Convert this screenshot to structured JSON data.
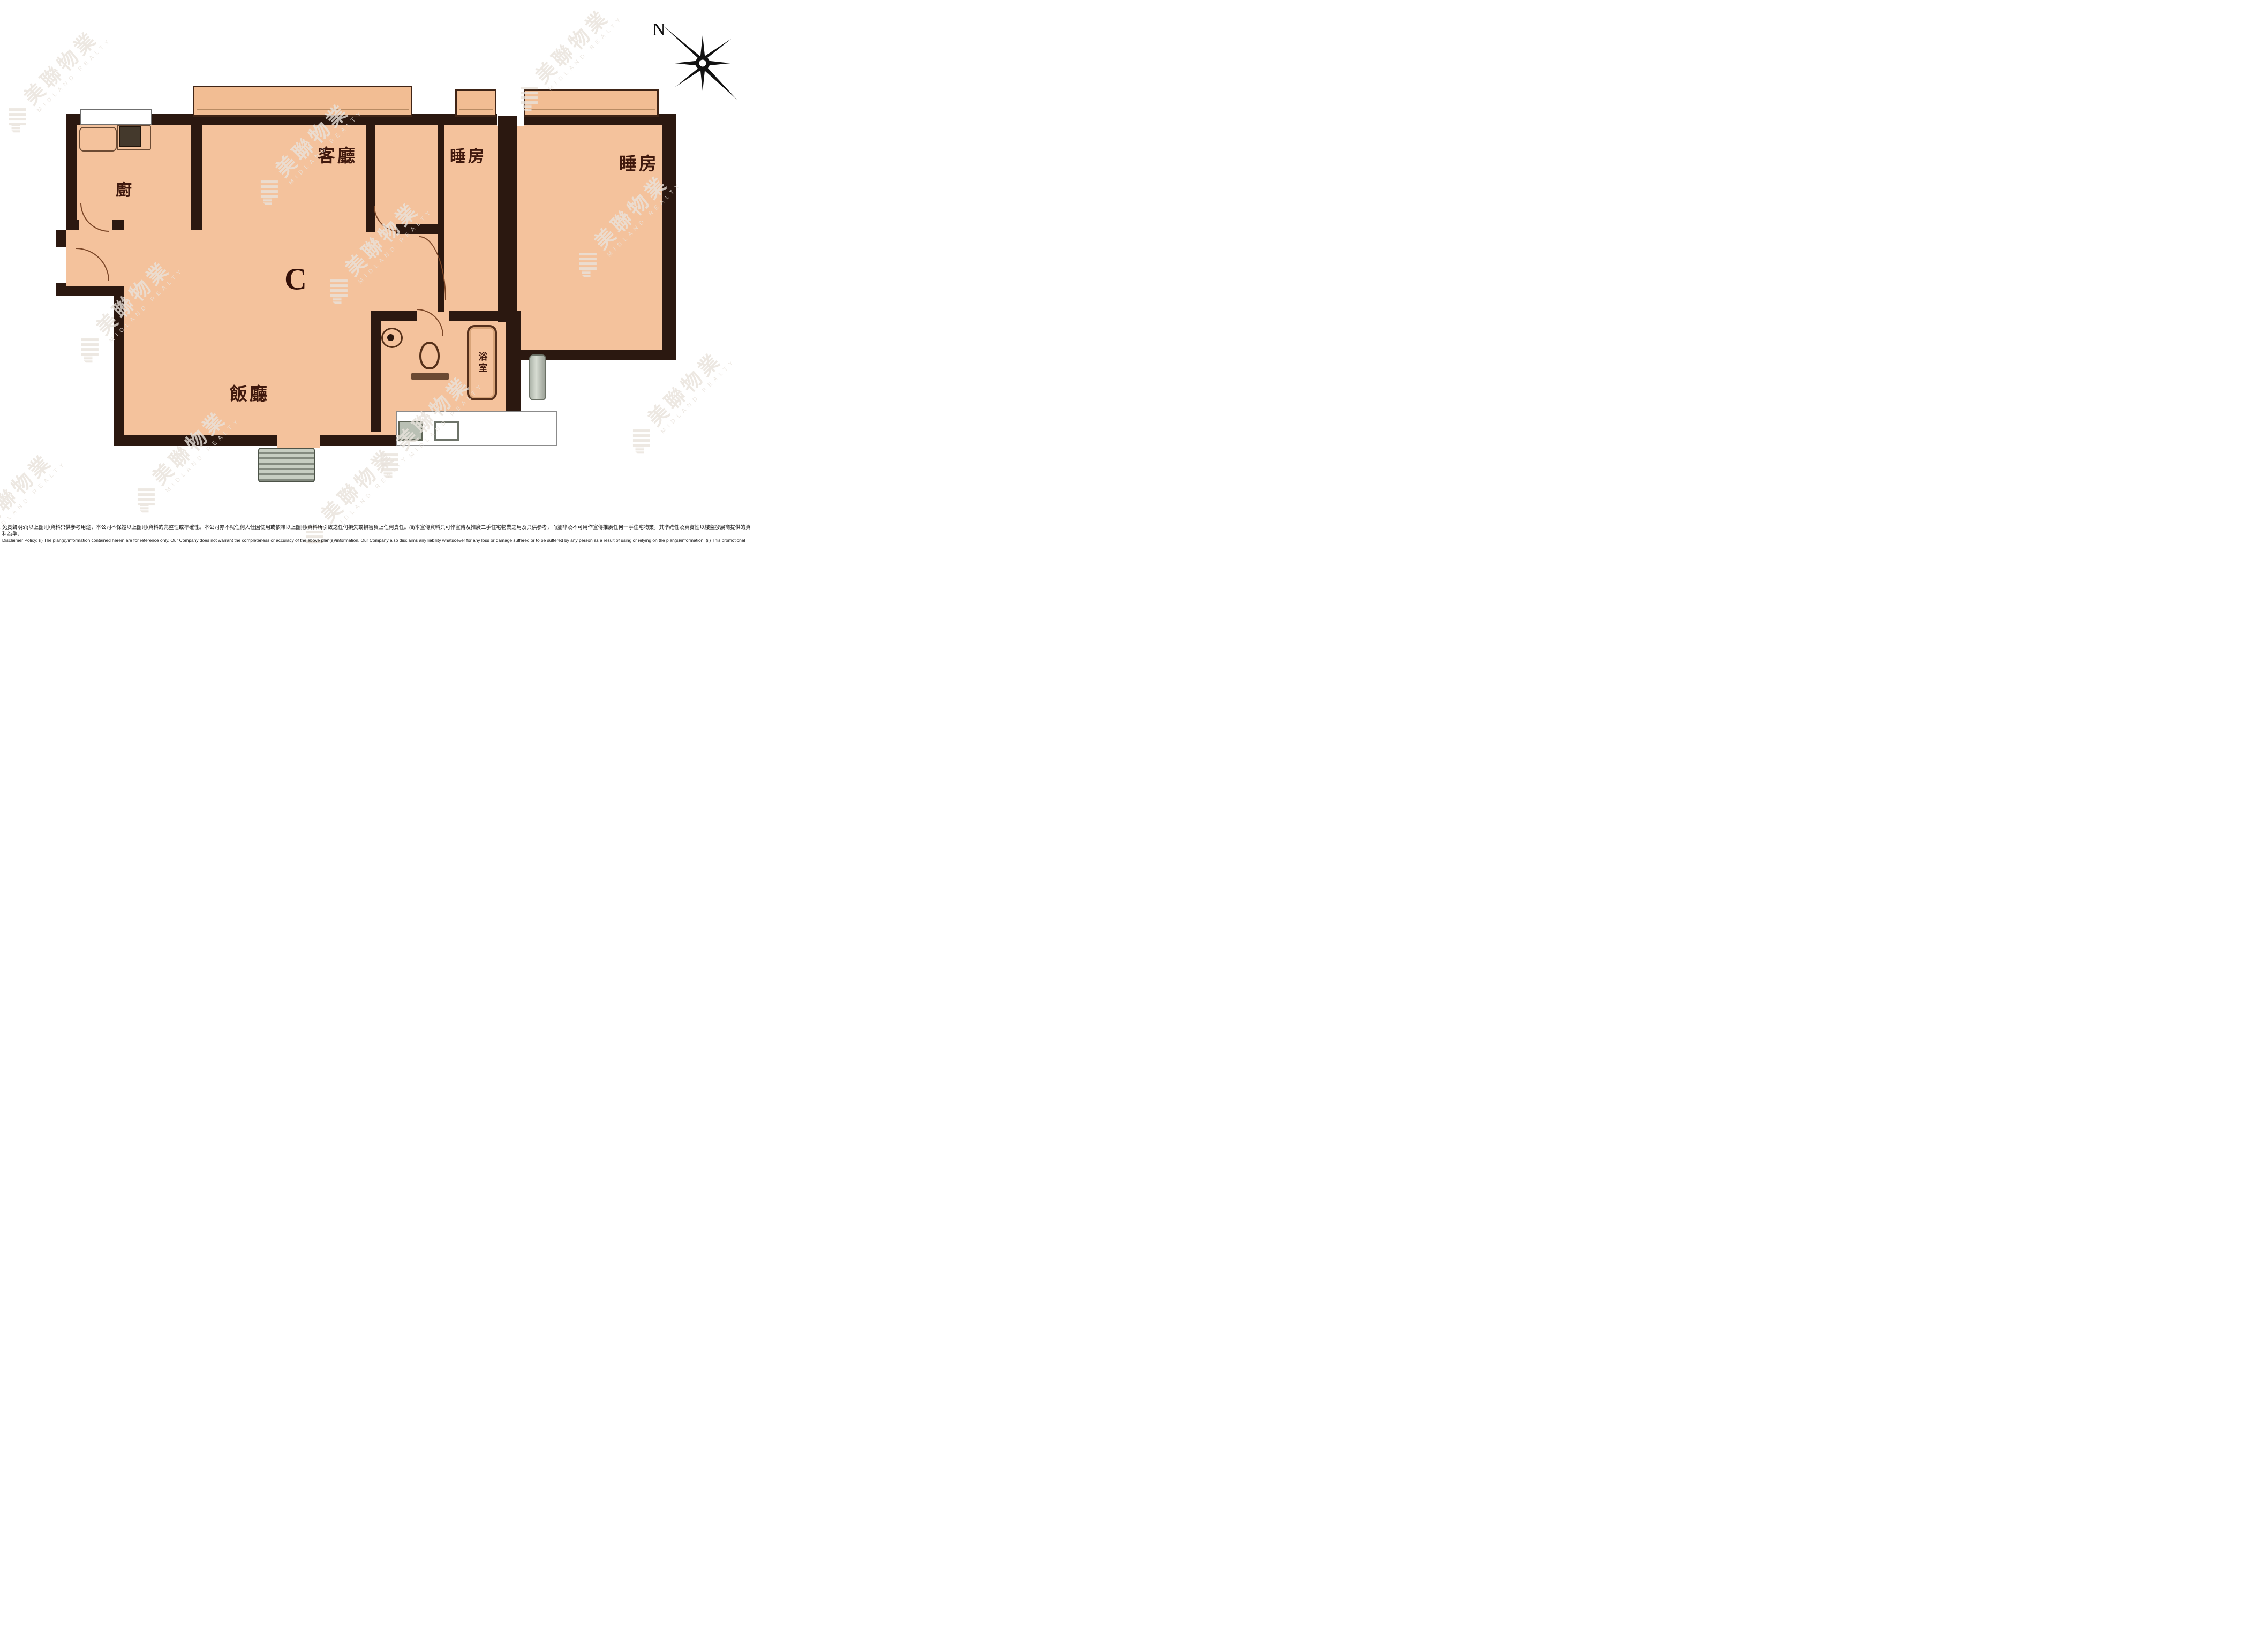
{
  "plan": {
    "unit_label": "C",
    "rooms": {
      "living": {
        "label": "客廳"
      },
      "bedroom1": {
        "label": "睡房"
      },
      "bedroom2": {
        "label": "睡房"
      },
      "kitchen": {
        "label": "廚"
      },
      "dining": {
        "label": "飯廳"
      },
      "bathroom": {
        "label": "浴室"
      }
    }
  },
  "compass": {
    "north_label": "N"
  },
  "watermark": {
    "cjk": "美聯物業",
    "latin": "MIDLAND REALTY"
  },
  "disclaimer": {
    "zh": "免責聲明:(i)以上圖則/資料只供參考用途，本公司不保證以上圖則/資料的完整性或準確性。本公司亦不就任何人仕因使用或依賴以上圖則/資料所引致之任何損失或損害負上任何責任。(ii)本宣傳資料只可作宣傳及推廣二手住宅物業之用及只供參考，而並非及不可用作宣傳推廣任何一手住宅物業，其準確性及真實性以樓盤發展商提供的資料為準。",
    "en1": "Disclaimer Policy: (i) The plan(s)/information contained herein are for reference only. Our Company does not warrant the completeness or accuracy of the above plan(s)/information. Our Company also disclaims any liability whatsoever for any loss or damage suffered or to be suffered by any person as a result of using or relying on the plan(s)/information. (ii) This promotional material is for the purpose of promoting",
    "en2": "second-hand residential properties and for reference only. This promotional material shall not be used for the purpose of promoting first-hand residential properties. The accuracy and truth of the information contained in this promotional material shall be subject to information provided by the developers."
  },
  "colors": {
    "floor": "#f4c29c",
    "wall": "#2b1810",
    "label_text": "#40190e",
    "fixture_grey": "#9aa096"
  }
}
